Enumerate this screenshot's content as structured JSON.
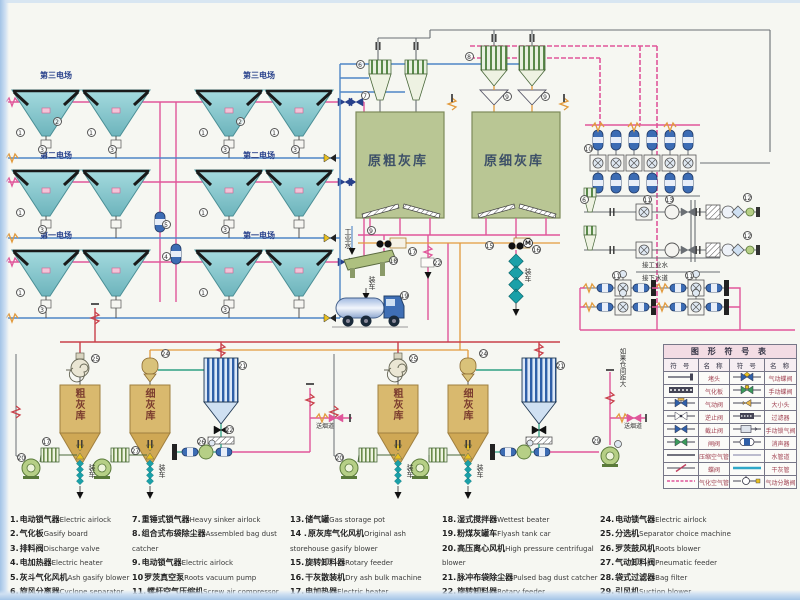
{
  "colors": {
    "pink": "#e0569a",
    "red": "#c9404a",
    "blue": "#4f86c6",
    "lightblue": "#7fb2dc",
    "gray": "#6a6f74",
    "green": "#2ea183",
    "orange": "#e29a3c",
    "teal": "#189fa8",
    "navy": "#27408b",
    "hopper": "#8ed0d6",
    "olive": "#b9c694",
    "tan": "#d9b96e",
    "bagblue": "#2f5fa8",
    "dark": "#2b2b2b"
  },
  "esp": {
    "fields": {
      "third": "第三电场",
      "second": "第二电场",
      "first": "第一电场"
    }
  },
  "silos": {
    "raw_coarse": "原粗灰库",
    "raw_fine": "原细灰库",
    "coarse": "粗灰库",
    "fine": "细灰库"
  },
  "annotations": {
    "industrial_water": "工业水",
    "load_truck": "装车",
    "connect_industrial_water": "接工业水",
    "connect_sewer": "接下水道",
    "if_spacing_large": "如果仓间距大",
    "to_flue": "送烟道",
    "motor": "M"
  },
  "callouts": [
    [
      2,
      57,
      121
    ],
    [
      1,
      20,
      132
    ],
    [
      3,
      42,
      149
    ],
    [
      1,
      91,
      132
    ],
    [
      3,
      112,
      149
    ],
    [
      2,
      240,
      121
    ],
    [
      1,
      203,
      132
    ],
    [
      3,
      225,
      149
    ],
    [
      1,
      274,
      132
    ],
    [
      3,
      295,
      149
    ],
    [
      1,
      20,
      212
    ],
    [
      3,
      42,
      229
    ],
    [
      1,
      203,
      212
    ],
    [
      3,
      225,
      229
    ],
    [
      1,
      20,
      292
    ],
    [
      3,
      42,
      309
    ],
    [
      1,
      203,
      292
    ],
    [
      3,
      225,
      309
    ],
    [
      5,
      166,
      224
    ],
    [
      4,
      166,
      256
    ],
    [
      6,
      360,
      64
    ],
    [
      7,
      365,
      95
    ],
    [
      8,
      469,
      56
    ],
    [
      9,
      507,
      96
    ],
    [
      9,
      545,
      96
    ],
    [
      9,
      371,
      230
    ],
    [
      17,
      412,
      251
    ],
    [
      18,
      393,
      260
    ],
    [
      19,
      404,
      295
    ],
    [
      22,
      437,
      262
    ],
    [
      15,
      489,
      245
    ],
    [
      16,
      536,
      249
    ],
    [
      10,
      588,
      148
    ],
    [
      6,
      584,
      199
    ],
    [
      11,
      647,
      199
    ],
    [
      13,
      669,
      199
    ],
    [
      12,
      747,
      197
    ],
    [
      12,
      747,
      235
    ],
    [
      11,
      616,
      275
    ],
    [
      11,
      689,
      275
    ],
    [
      25,
      95,
      358
    ],
    [
      24,
      165,
      353
    ],
    [
      20,
      21,
      457
    ],
    [
      17,
      46,
      441
    ],
    [
      21,
      242,
      365
    ],
    [
      22,
      229,
      429
    ],
    [
      26,
      201,
      441
    ],
    [
      27,
      135,
      450
    ],
    [
      25,
      413,
      358
    ],
    [
      24,
      483,
      353
    ],
    [
      20,
      339,
      457
    ],
    [
      21,
      560,
      365
    ],
    [
      29,
      596,
      440
    ]
  ],
  "motors": [
    [
      528,
      243
    ]
  ],
  "symbol_table": {
    "title": "图 形 符 号 表",
    "headers": [
      "符 号",
      "名 称",
      "符 号",
      "名 称"
    ],
    "rows": [
      {
        "lsym": "plug",
        "left": "堵头",
        "rsym": "pneu-butterfly",
        "right": "气动蝶阀"
      },
      {
        "lsym": "gasify-board",
        "left": "气化板",
        "rsym": "manual-butterfly",
        "right": "手动蝶阀"
      },
      {
        "lsym": "pneu-valve",
        "left": "气动阀",
        "rsym": "reducer",
        "right": "大小头"
      },
      {
        "lsym": "check-valve",
        "left": "逆止阀",
        "rsym": "filter",
        "right": "过滤器"
      },
      {
        "lsym": "stop-valve",
        "left": "截止阀",
        "rsym": "manual-airlock",
        "right": "手动锁气阀"
      },
      {
        "lsym": "gate-valve",
        "left": "闸阀",
        "rsym": "silencer",
        "right": "消声器"
      },
      {
        "lsym": "air-pipe",
        "left": "压缩空气管",
        "rsym": "water-pipe",
        "right": "水管道"
      },
      {
        "lsym": "butterfly",
        "left": "蝶阀",
        "rsym": "ash-pipe",
        "right": "干灰管"
      },
      {
        "lsym": "gasify-pipe",
        "left": "气化空气管",
        "rsym": "diverter",
        "right": "气动分路阀"
      }
    ]
  },
  "legend_list": {
    "columns": [
      [
        {
          "num": "1.",
          "zh": "电动锁气器",
          "en": "Electric airlock"
        },
        {
          "num": "2.",
          "zh": "气化板",
          "en": "Gasify board"
        },
        {
          "num": "3.",
          "zh": "排料阀",
          "en": "Discharge valve"
        },
        {
          "num": "4.",
          "zh": "电加热器",
          "en": "Electric heater"
        },
        {
          "num": "5.",
          "zh": "灰斗气化风机",
          "en": "Ash gasify blower"
        },
        {
          "num": "6.",
          "zh": "旋风分离器",
          "en": "Cyclone separator"
        }
      ],
      [
        {
          "num": "7.",
          "zh": "重锤式锁气器",
          "en": "Heavy sinker airlock"
        },
        {
          "num": "8.",
          "zh": "组合式布袋除尘器",
          "en": "Assembled bag dust catcher"
        },
        {
          "num": "9.",
          "zh": "电动锁气器",
          "en": "Electric airlock"
        },
        {
          "num": "10",
          "zh": "罗茨真空泵",
          "en": "Roots vacuum pump"
        },
        {
          "num": "11.",
          "zh": "螺杆空气压缩机",
          "en": "Screw air compressor"
        },
        {
          "num": "12.",
          "zh": "冷冻干燥器",
          "en": "Freeze dryer"
        }
      ],
      [
        {
          "num": "13.",
          "zh": "储气罐",
          "en": "Gas storage pot"
        },
        {
          "num": "14 .",
          "zh": "原灰库气化风机",
          "en": "Original ash storehouse gasify blower"
        },
        {
          "num": "15.",
          "zh": "旋转卸料器",
          "en": "Rotary feeder"
        },
        {
          "num": "16.",
          "zh": "干灰散装机",
          "en": "Dry ash bulk machine"
        },
        {
          "num": "17.",
          "zh": "电加热器",
          "en": "Electric heater"
        }
      ],
      [
        {
          "num": "18.",
          "zh": "湿式搅拌器",
          "en": "Wettest beater"
        },
        {
          "num": "19.",
          "zh": "粉煤灰罐车",
          "en": "Flyash tank car"
        },
        {
          "num": "20.",
          "zh": "高压离心风机",
          "en": "High pressure centrifugal blower"
        },
        {
          "num": "21.",
          "zh": "脉冲布袋除尘器",
          "en": "Pulsed bag dust catcher"
        },
        {
          "num": "22.",
          "zh": "旋转卸料器",
          "en": "Rotary feeder"
        },
        {
          "num": "23",
          "zh": "多管收集器",
          "en": "Multi pipe collector"
        }
      ],
      [
        {
          "num": "24.",
          "zh": "电动锁气器",
          "en": "Electric airlock"
        },
        {
          "num": "25.",
          "zh": "分选机",
          "en": "Separator choice machine"
        },
        {
          "num": "26.",
          "zh": "罗茨鼓风机",
          "en": "Roots blower"
        },
        {
          "num": "27.",
          "zh": "气动卸料阀",
          "en": "Pneumatic feeder"
        },
        {
          "num": "28.",
          "zh": "袋式过滤器",
          "en": "Bag filter"
        },
        {
          "num": "29.",
          "zh": "引风机",
          "en": "Suction blower"
        }
      ]
    ]
  }
}
